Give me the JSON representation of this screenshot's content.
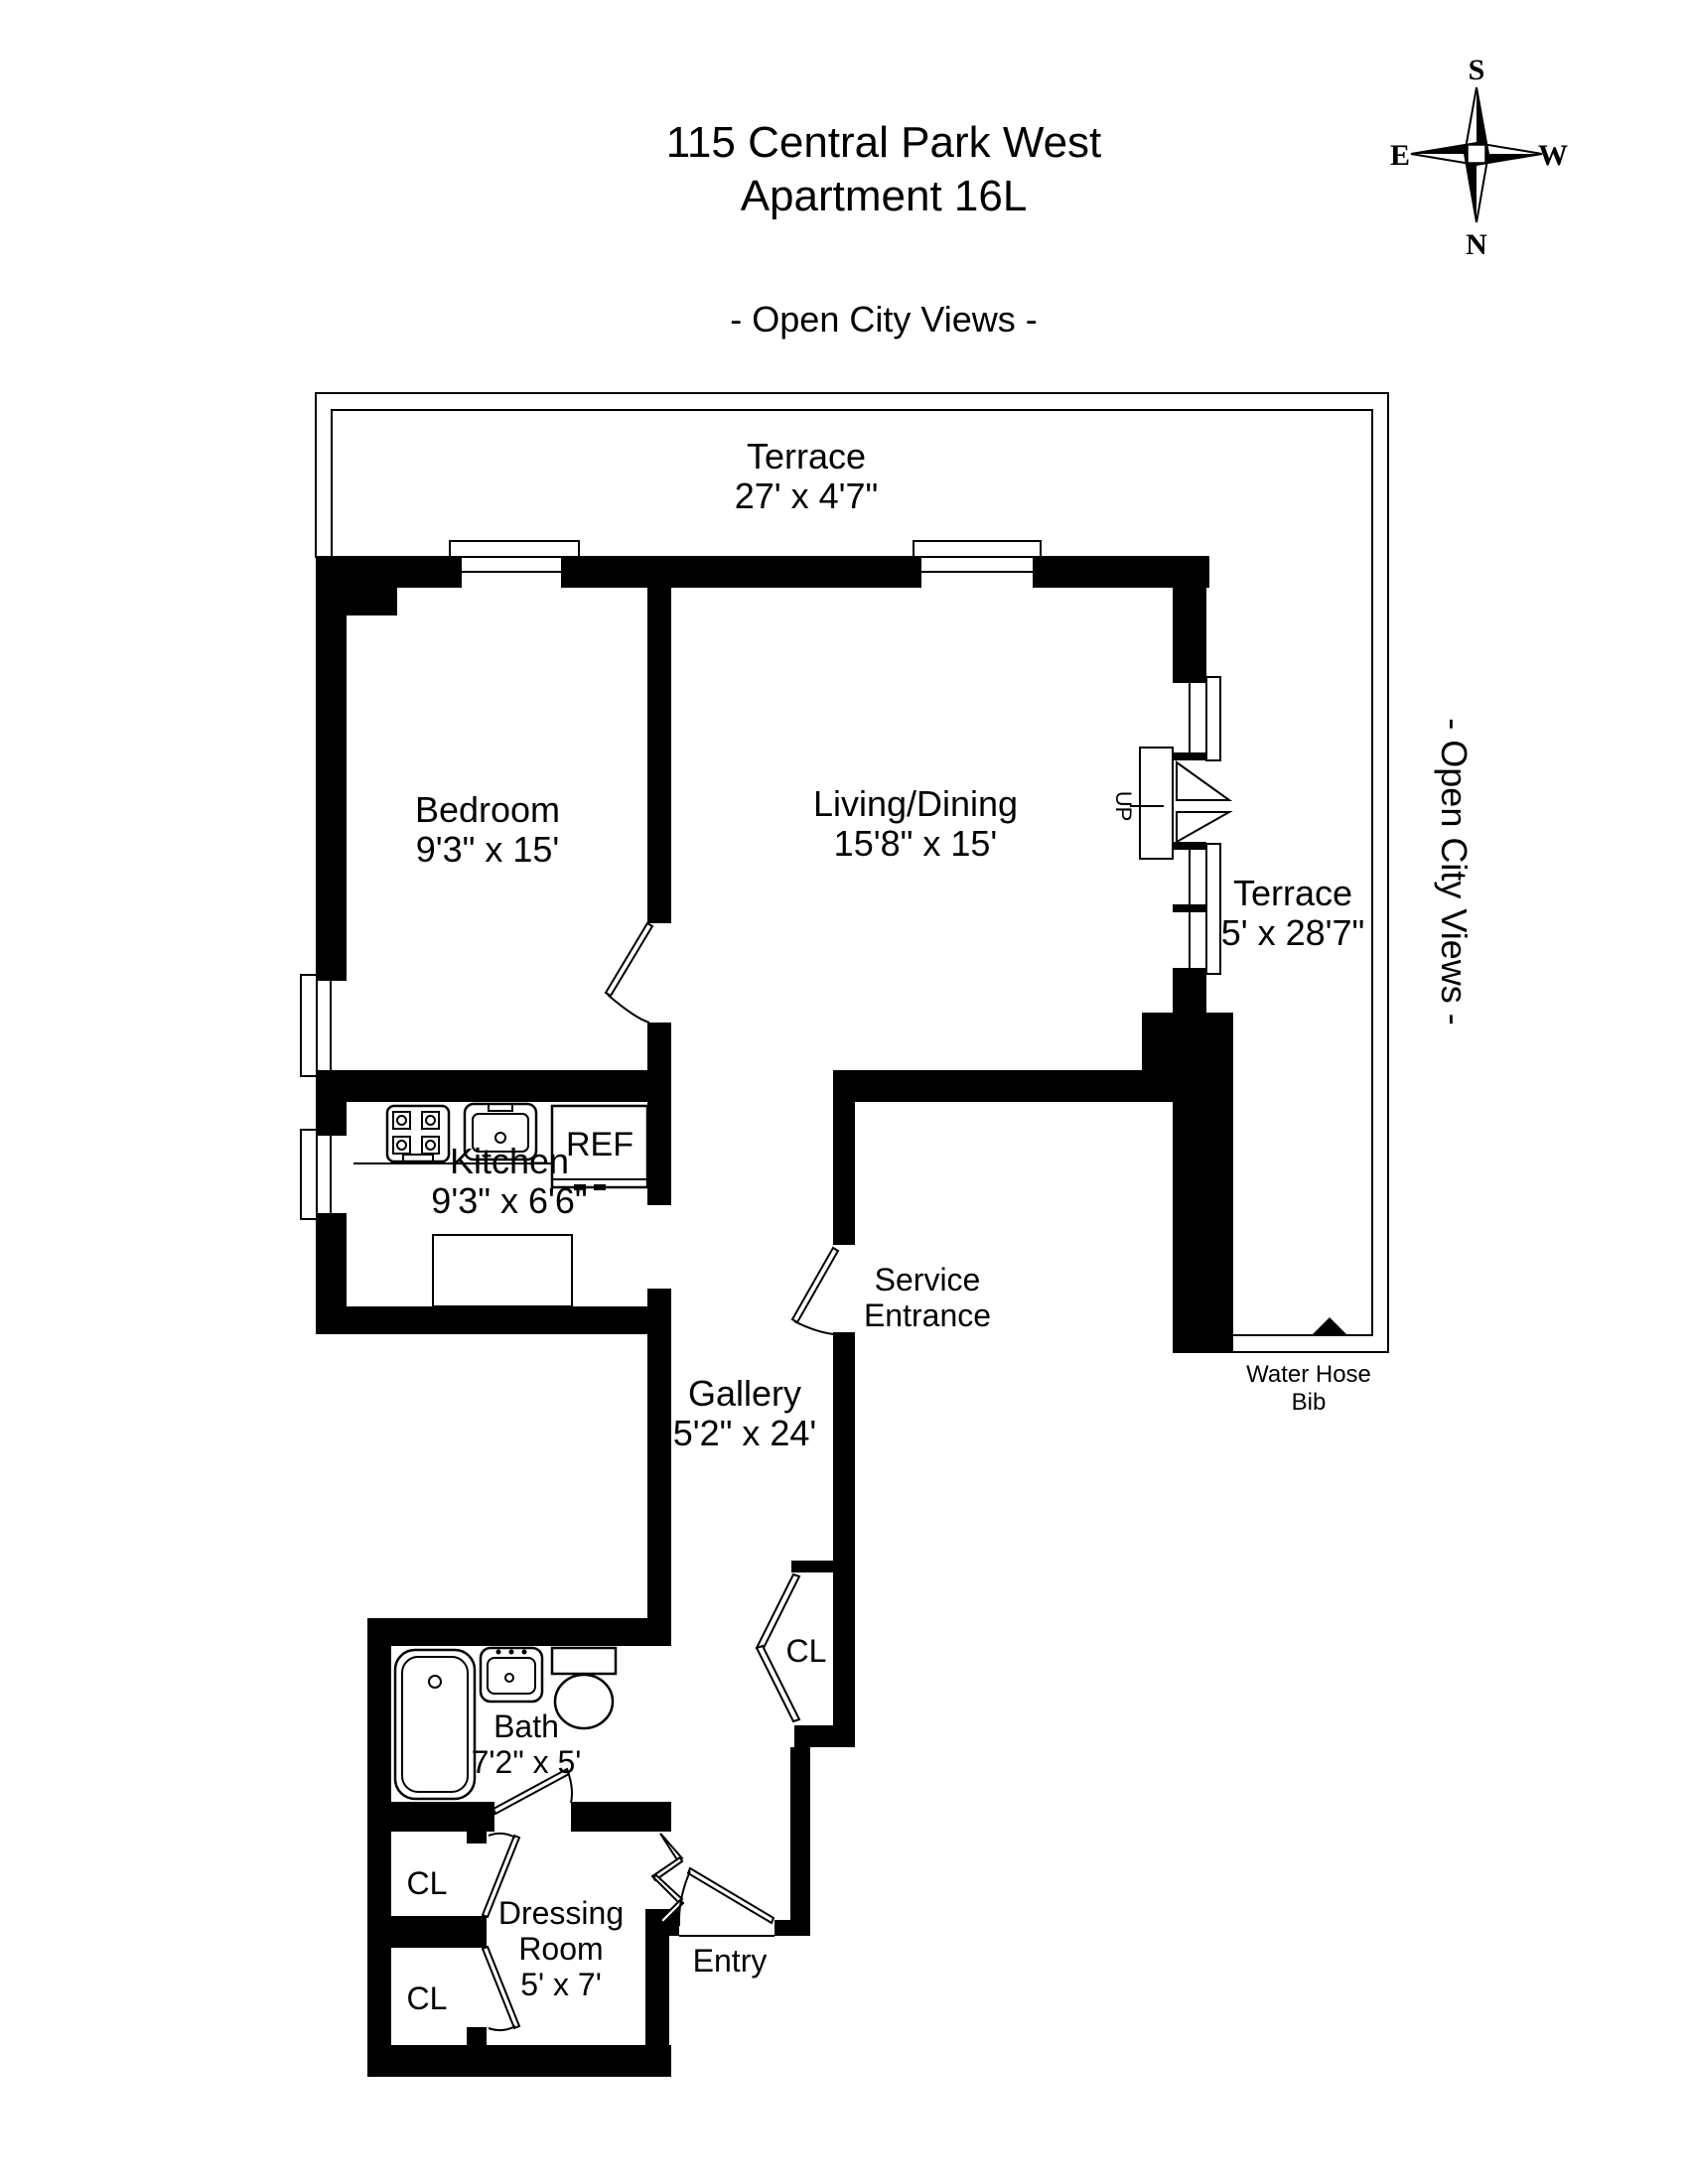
{
  "colors": {
    "ink": "#000000",
    "paper": "#ffffff"
  },
  "header": {
    "title_line1": "115 Central Park West",
    "title_line2": "Apartment 16L",
    "views_top": "- Open City Views -",
    "views_right": "- Open City Views -"
  },
  "compass": {
    "s": "S",
    "n": "N",
    "e": "E",
    "w": "W"
  },
  "rooms": {
    "terrace_top": {
      "name": "Terrace",
      "dims": "27' x 4'7\""
    },
    "terrace_right": {
      "name": "Terrace",
      "dims": "5' x 28'7\""
    },
    "bedroom": {
      "name": "Bedroom",
      "dims": "9'3\" x 15'"
    },
    "living": {
      "name": "Living/Dining",
      "dims": "15'8\" x 15'"
    },
    "kitchen": {
      "name": "Kitchen",
      "dims": "9'3\" x 6'6\""
    },
    "gallery": {
      "name": "Gallery",
      "dims": "5'2\" x 24'"
    },
    "bath": {
      "name": "Bath",
      "dims": "7'2\" x 5'"
    },
    "dressing": {
      "name": "Dressing",
      "name2": "Room",
      "dims": "5' x 7'"
    }
  },
  "labels": {
    "service_line1": "Service",
    "service_line2": "Entrance",
    "entry": "Entry",
    "up": "UP",
    "ref": "REF",
    "water_hose_line1": "Water Hose",
    "water_hose_line2": "Bib"
  },
  "closets": {
    "gallery": "CL",
    "upper": "CL",
    "lower": "CL"
  }
}
